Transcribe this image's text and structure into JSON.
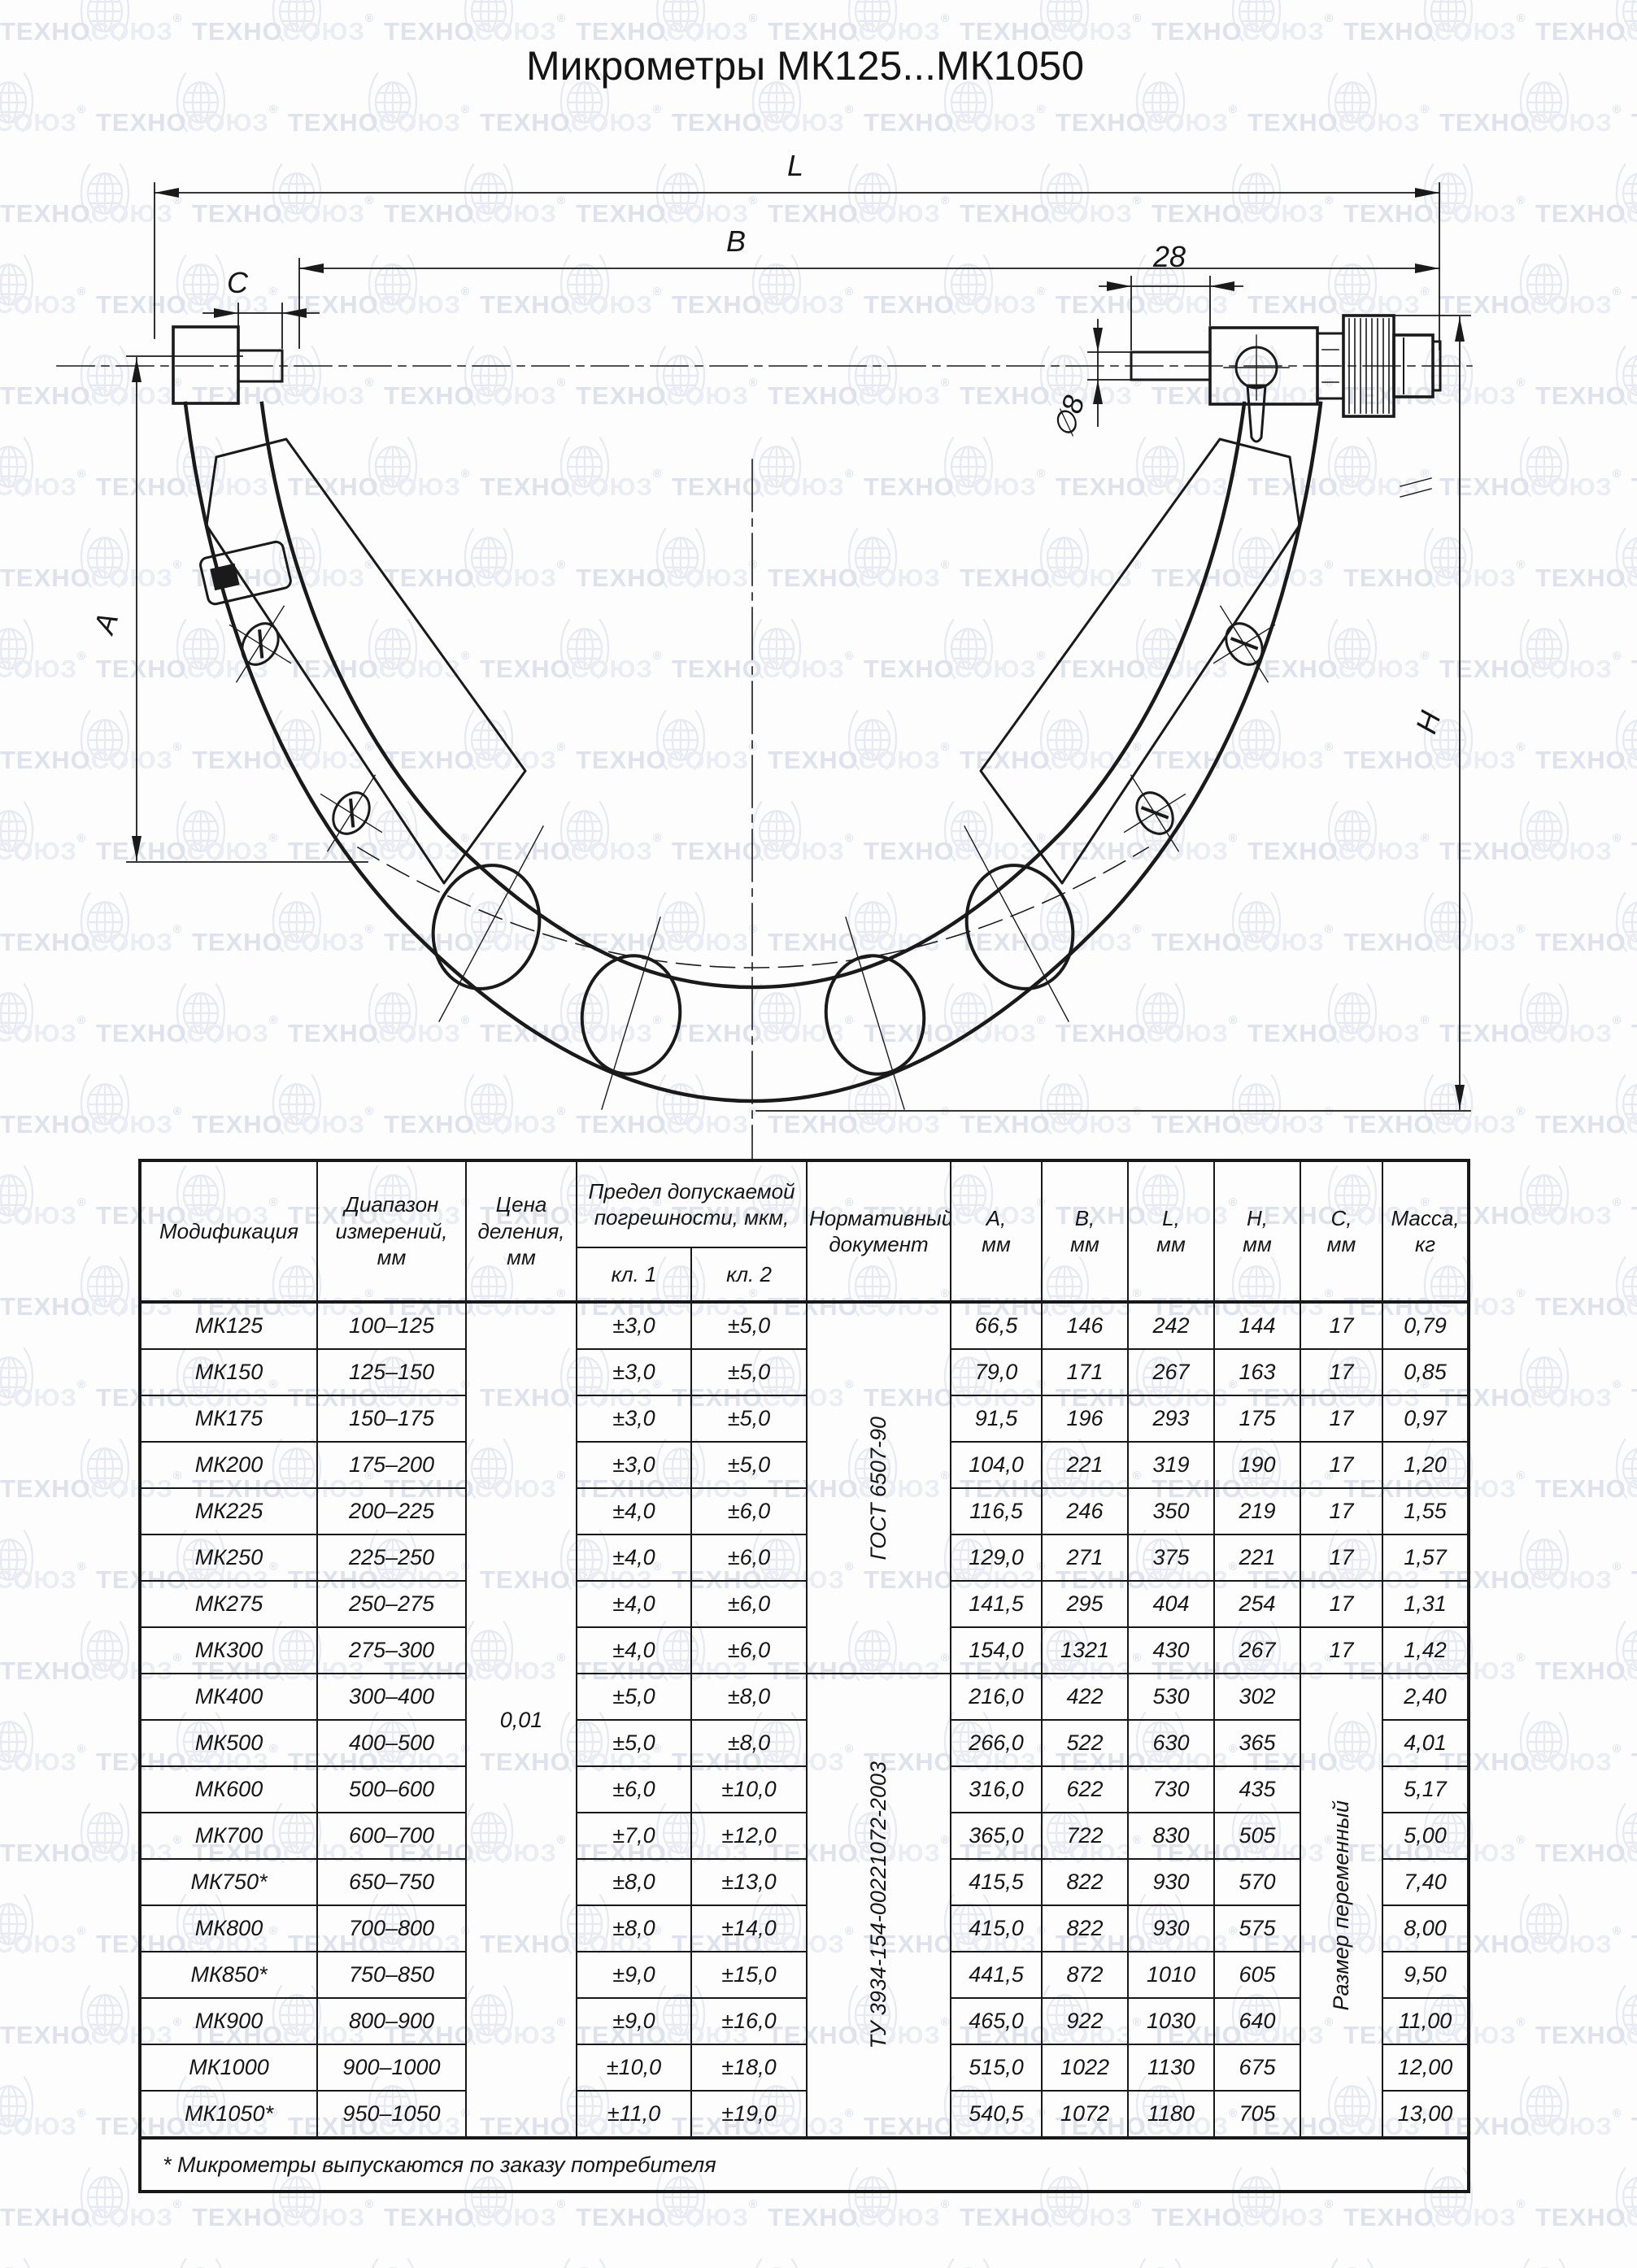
{
  "title": "Микрометры МК125...МК1050",
  "watermark": {
    "brand_primary": "ТЕХНО",
    "brand_secondary": "СОЮЗ",
    "registered": "®"
  },
  "colors": {
    "ink": "#1a1a1a",
    "wm_text_dark": "#dde2ec",
    "wm_text_light": "#eaedf4",
    "wm_line": "#e7eaf2"
  },
  "drawing": {
    "labels": {
      "L": "L",
      "B": "B",
      "C": "C",
      "dim28": "28",
      "dia8": "∅8",
      "A": "A",
      "H": "H"
    }
  },
  "table": {
    "headers": {
      "modification": "Модификация",
      "range": "Диапазон измерений, мм",
      "division": "Цена деления, мм",
      "error_group": "Предел допускаемой погрешности, мкм,",
      "class1": "кл. 1",
      "class2": "кл. 2",
      "document": "Нормативный документ",
      "dims": [
        {
          "letter": "A,",
          "unit": "мм"
        },
        {
          "letter": "B,",
          "unit": "мм"
        },
        {
          "letter": "L,",
          "unit": "мм"
        },
        {
          "letter": "H,",
          "unit": "мм"
        },
        {
          "letter": "C,",
          "unit": "мм"
        },
        {
          "letter": "Масса,",
          "unit": "кг"
        }
      ]
    },
    "merged": {
      "division_value": "0,01",
      "doc1": "ГОСТ 6507-90",
      "doc1_rowspan": 8,
      "doc2": "ТУ 3934-154-00221072-2003",
      "doc2_rowspan": 11,
      "c_variable": "Размер переменный",
      "c_variable_rowspan": 11
    },
    "rows": [
      {
        "model": "МК125",
        "range": "100–125",
        "kl1": "±3,0",
        "kl2": "±5,0",
        "a": "66,5",
        "b": "146",
        "l": "242",
        "h": "144",
        "c": "17",
        "mass": "0,79"
      },
      {
        "model": "МК150",
        "range": "125–150",
        "kl1": "±3,0",
        "kl2": "±5,0",
        "a": "79,0",
        "b": "171",
        "l": "267",
        "h": "163",
        "c": "17",
        "mass": "0,85"
      },
      {
        "model": "МК175",
        "range": "150–175",
        "kl1": "±3,0",
        "kl2": "±5,0",
        "a": "91,5",
        "b": "196",
        "l": "293",
        "h": "175",
        "c": "17",
        "mass": "0,97"
      },
      {
        "model": "МК200",
        "range": "175–200",
        "kl1": "±3,0",
        "kl2": "±5,0",
        "a": "104,0",
        "b": "221",
        "l": "319",
        "h": "190",
        "c": "17",
        "mass": "1,20"
      },
      {
        "model": "МК225",
        "range": "200–225",
        "kl1": "±4,0",
        "kl2": "±6,0",
        "a": "116,5",
        "b": "246",
        "l": "350",
        "h": "219",
        "c": "17",
        "mass": "1,55"
      },
      {
        "model": "МК250",
        "range": "225–250",
        "kl1": "±4,0",
        "kl2": "±6,0",
        "a": "129,0",
        "b": "271",
        "l": "375",
        "h": "221",
        "c": "17",
        "mass": "1,57"
      },
      {
        "model": "МК275",
        "range": "250–275",
        "kl1": "±4,0",
        "kl2": "±6,0",
        "a": "141,5",
        "b": "295",
        "l": "404",
        "h": "254",
        "c": "17",
        "mass": "1,31"
      },
      {
        "model": "МК300",
        "range": "275–300",
        "kl1": "±4,0",
        "kl2": "±6,0",
        "a": "154,0",
        "b": "1321",
        "l": "430",
        "h": "267",
        "c": "17",
        "mass": "1,42"
      },
      {
        "model": "МК400",
        "range": "300–400",
        "kl1": "±5,0",
        "kl2": "±8,0",
        "a": "216,0",
        "b": "422",
        "l": "530",
        "h": "302",
        "c": "",
        "mass": "2,40"
      },
      {
        "model": "МК500",
        "range": "400–500",
        "kl1": "±5,0",
        "kl2": "±8,0",
        "a": "266,0",
        "b": "522",
        "l": "630",
        "h": "365",
        "c": "",
        "mass": "4,01"
      },
      {
        "model": "МК600",
        "range": "500–600",
        "kl1": "±6,0",
        "kl2": "±10,0",
        "a": "316,0",
        "b": "622",
        "l": "730",
        "h": "435",
        "c": "",
        "mass": "5,17"
      },
      {
        "model": "МК700",
        "range": "600–700",
        "kl1": "±7,0",
        "kl2": "±12,0",
        "a": "365,0",
        "b": "722",
        "l": "830",
        "h": "505",
        "c": "",
        "mass": "5,00"
      },
      {
        "model": "МК750*",
        "range": "650–750",
        "kl1": "±8,0",
        "kl2": "±13,0",
        "a": "415,5",
        "b": "822",
        "l": "930",
        "h": "570",
        "c": "",
        "mass": "7,40"
      },
      {
        "model": "МК800",
        "range": "700–800",
        "kl1": "±8,0",
        "kl2": "±14,0",
        "a": "415,0",
        "b": "822",
        "l": "930",
        "h": "575",
        "c": "",
        "mass": "8,00"
      },
      {
        "model": "МК850*",
        "range": "750–850",
        "kl1": "±9,0",
        "kl2": "±15,0",
        "a": "441,5",
        "b": "872",
        "l": "1010",
        "h": "605",
        "c": "",
        "mass": "9,50"
      },
      {
        "model": "МК900",
        "range": "800–900",
        "kl1": "±9,0",
        "kl2": "±16,0",
        "a": "465,0",
        "b": "922",
        "l": "1030",
        "h": "640",
        "c": "",
        "mass": "11,00"
      },
      {
        "model": "МК1000",
        "range": "900–1000",
        "kl1": "±10,0",
        "kl2": "±18,0",
        "a": "515,0",
        "b": "1022",
        "l": "1130",
        "h": "675",
        "c": "",
        "mass": "12,00"
      },
      {
        "model": "МК1050*",
        "range": "950–1050",
        "kl1": "±11,0",
        "kl2": "±19,0",
        "a": "540,5",
        "b": "1072",
        "l": "1180",
        "h": "705",
        "c": "",
        "mass": "13,00"
      }
    ],
    "footnote": "* Микрометры выпускаются по заказу потребителя"
  }
}
